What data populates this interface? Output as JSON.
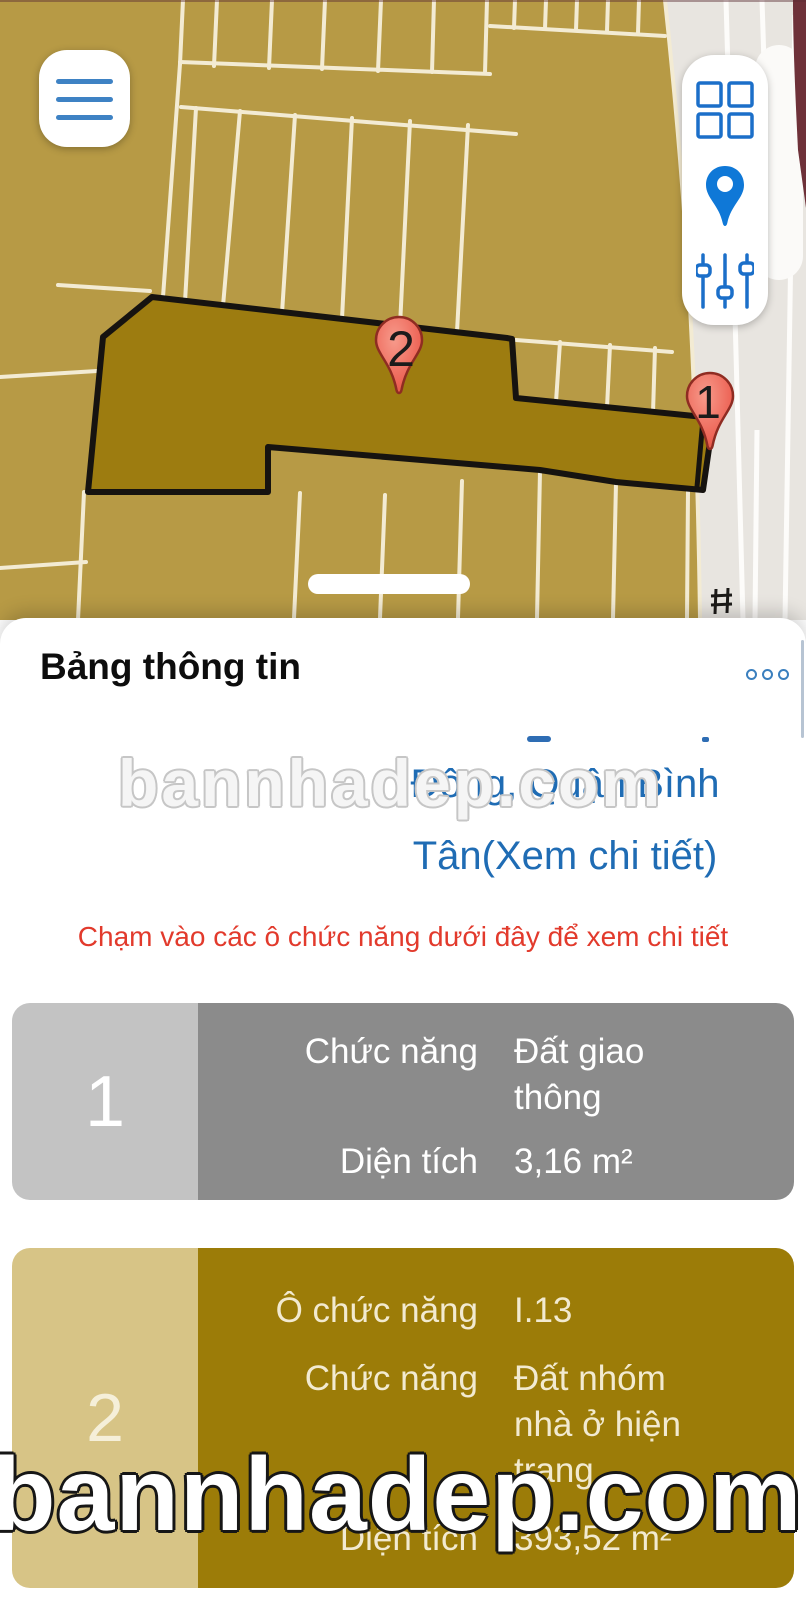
{
  "colors": {
    "map_base": "#b79a45",
    "parcel_highlight": "#9d7c10",
    "parcel_line": "#f3ebd3",
    "road": "#e8e5e0",
    "road_edge_maroon": "#6e3139",
    "accent_blue": "#1b6fc9",
    "address_blue": "#1f6cb4",
    "tip_red": "#e23a2c",
    "pin_red": "#e9594c",
    "card1_left": "#c3c3c3",
    "card1_right": "#8b8b8b",
    "card2_left": "#d7c486",
    "card2_right": "#9c7c08"
  },
  "map": {
    "pins": [
      {
        "number": "1"
      },
      {
        "number": "2"
      }
    ]
  },
  "controls": {
    "menu_icon": "hamburger-menu",
    "layers_icon": "grid-squares",
    "locate_icon": "location-pin",
    "filters_icon": "sliders"
  },
  "panel": {
    "title": "Bảng thông tin",
    "more_dots_count": 3,
    "address": {
      "line1": "Đông, Quận Bình",
      "line2": "Tân(Xem chi tiết)"
    },
    "tip": "Chạm vào các ô chức năng dưới đây để xem chi tiết",
    "cards": [
      {
        "index": "1",
        "rows": [
          {
            "label": "Chức năng",
            "value": "Đất giao thông"
          },
          {
            "label": "Diện tích",
            "value": "3,16 m²"
          }
        ]
      },
      {
        "index": "2",
        "rows": [
          {
            "label": "Ô chức năng",
            "value": "I.13"
          },
          {
            "label": "Chức năng",
            "value": "Đất nhóm nhà ở hiện trạng"
          },
          {
            "label": "Diện tích",
            "value": "393,52 m²"
          }
        ]
      }
    ]
  },
  "watermark": {
    "text": "bannhadep.com"
  }
}
